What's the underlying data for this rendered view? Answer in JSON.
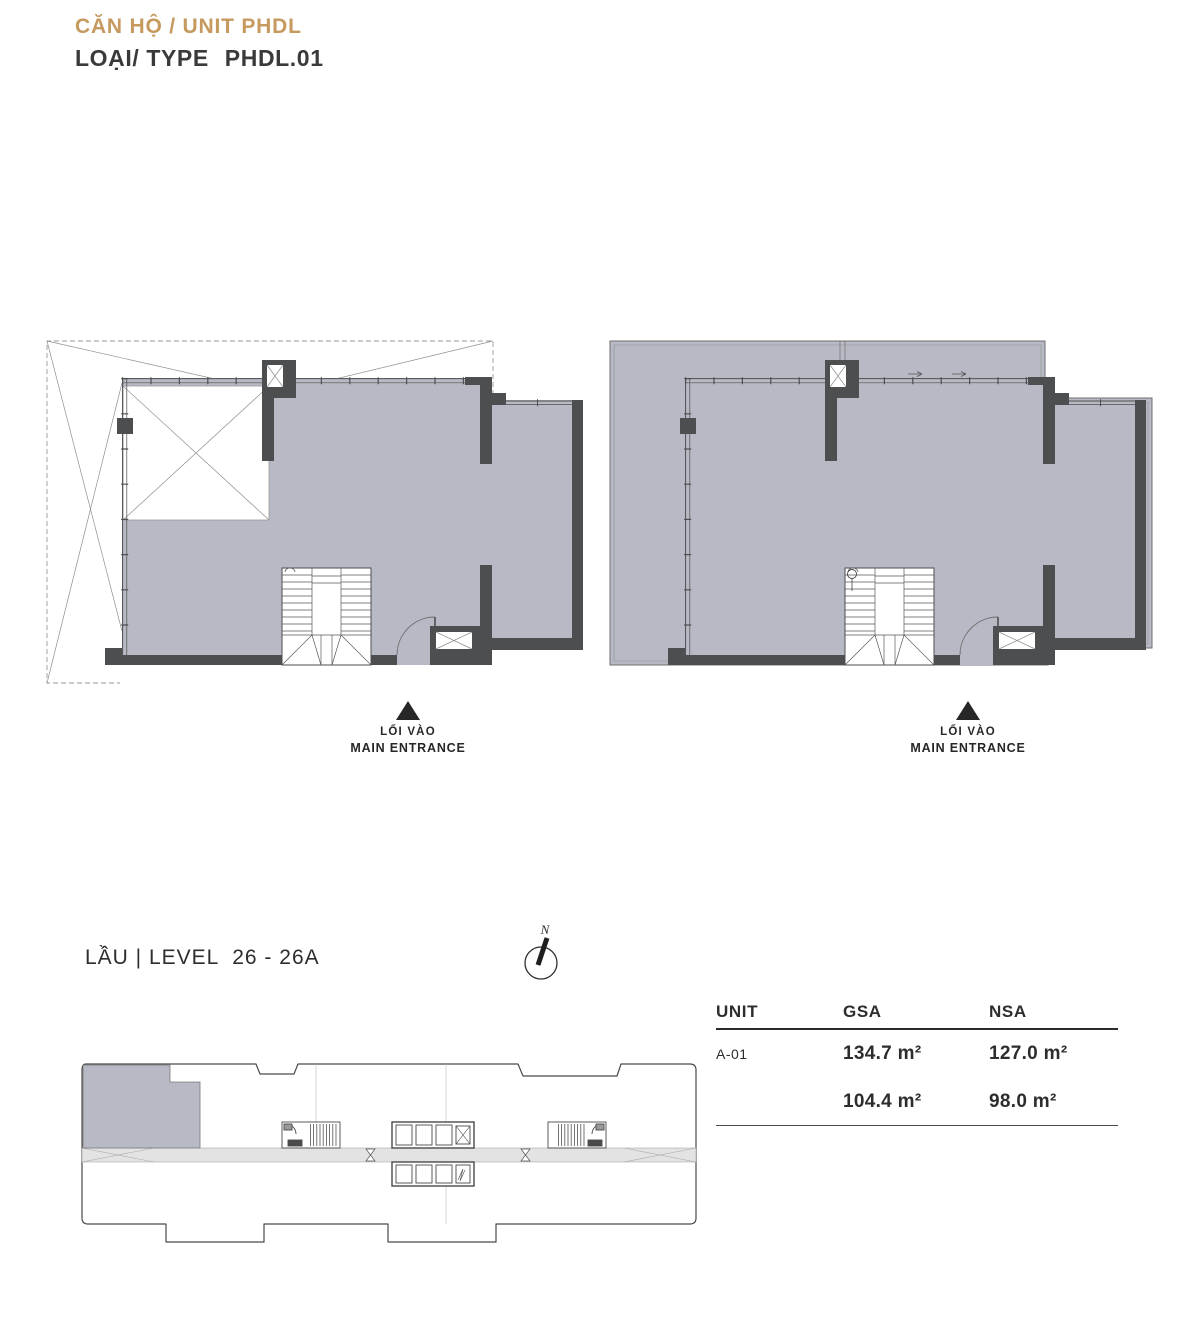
{
  "header": {
    "title": "CĂN HỘ / UNIT PHDL",
    "type_label": "LOẠI/ TYPE",
    "type_value": "PHDL.01"
  },
  "entrance_marker": {
    "line1": "LỐI VÀO",
    "line2": "MAIN ENTRANCE"
  },
  "level_label": "LẦU | LEVEL  26 - 26A",
  "compass_label": "N",
  "area_table": {
    "headers": {
      "unit": "UNIT",
      "gsa": "GSA",
      "nsa": "NSA"
    },
    "rows": [
      {
        "unit": "A-01",
        "gsa": "134.7 m²",
        "nsa": "127.0 m²"
      },
      {
        "unit": "",
        "gsa": "104.4 m²",
        "nsa": "98.0 m²"
      }
    ]
  },
  "colors": {
    "accent_gold": "#C6995E",
    "text_dark": "#3A3A3A",
    "floor_fill": "#B7BAC4",
    "wall_dark": "#4D4E50",
    "corridor_fill": "#E3E3E3",
    "entrance_marker": "#272727"
  }
}
